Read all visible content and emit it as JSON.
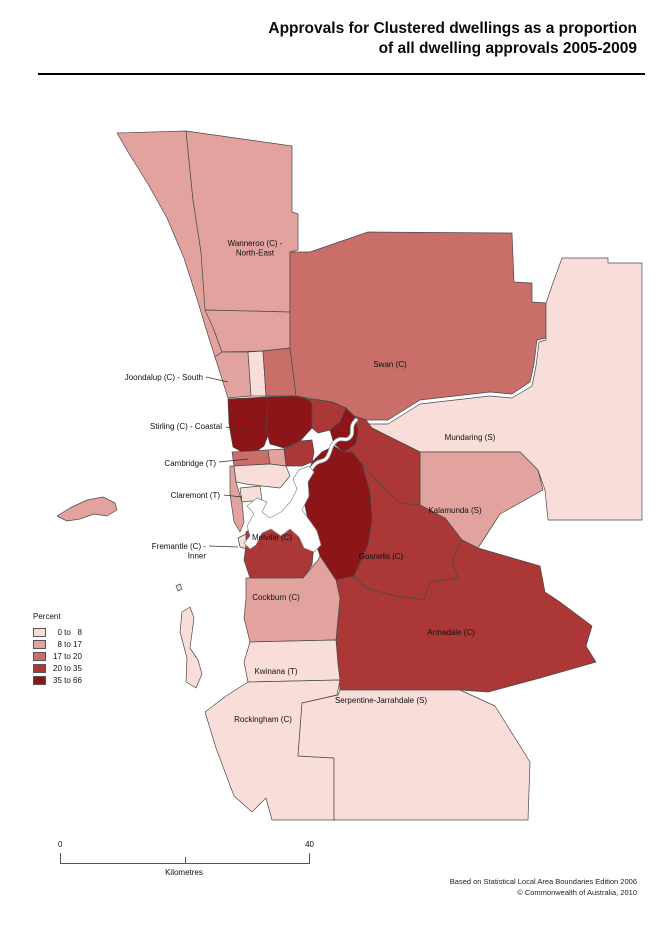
{
  "title": {
    "line1": "Approvals for Clustered dwellings as a proportion",
    "line2": "of all dwelling approvals 2005-2009"
  },
  "legend": {
    "title": "Percent",
    "items": [
      {
        "label": "  0 to   8",
        "color": "#f8ddd8"
      },
      {
        "label": "  8 to 17",
        "color": "#e2a29d"
      },
      {
        "label": "17 to 20",
        "color": "#c96e68"
      },
      {
        "label": "20 to 35",
        "color": "#ab3736"
      },
      {
        "label": "35 to 66",
        "color": "#8d1517"
      }
    ]
  },
  "scalebar": {
    "start": "0",
    "end": "40",
    "units": "Kilometres"
  },
  "footer": {
    "line1": "Based on Statistical Local Area Boundaries Edition 2006",
    "line2": "© Commonwealth of Australia, 2010"
  },
  "map": {
    "border_color": "#4a4a4a",
    "water_color": "#ffffff",
    "regions": [
      {
        "id": "wanneroo-coastal",
        "class": 1,
        "points": "117,133 186,131 193,200 201,252 207,300 214,330 222,352 215,357 207,332 198,302 184,258 167,218 148,184 128,152"
      },
      {
        "id": "wanneroo-north-east",
        "class": 1,
        "points": "186,131 292,146 292,212 298,214 298,250 290,252 290,312 205,310 201,252 193,200"
      },
      {
        "id": "wanneroo-south",
        "class": 1,
        "points": "205,310 290,312 290,348 262,351 222,352 214,330"
      },
      {
        "id": "joondalup-south",
        "class": 1,
        "points": "215,357 222,352 248,352 251,396 228,398"
      },
      {
        "id": "joondalup-east",
        "class": 0,
        "points": "248,352 263,351 266,396 251,396"
      },
      {
        "id": "wanneroo-sliver",
        "class": 2,
        "points": "263,351 290,348 296,396 266,396"
      },
      {
        "id": "swan",
        "class": 2,
        "points": "290,252 310,252 368,232 512,233 514,282 532,283 532,302 546,303 546,338 537,340 534,364 530,382 512,394 490,392 420,400 388,420 366,420 354,416 346,408 332,402 296,396 290,348 290,312"
      },
      {
        "id": "mundaring",
        "class": 0,
        "points": "562,258 608,258 608,263 642,263 642,520 548,520 545,490 538,470 520,452 420,452 372,428 366,424 388,424 420,404 490,396 512,398 532,386 536,366 539,342 546,340 546,303 554,280"
      },
      {
        "id": "kalamunda",
        "class": 1,
        "points": "420,452 520,452 538,470 543,490 500,514 478,548 462,540 445,518 420,505"
      },
      {
        "id": "stirling-coastal",
        "class": 4,
        "points": "228,399 266,397 268,404 270,430 264,446 254,453 242,452 233,447 229,424"
      },
      {
        "id": "stirling-central",
        "class": 4,
        "points": "266,397 296,396 308,399 312,404 312,428 300,441 284,448 270,444 266,428 268,404"
      },
      {
        "id": "stirling-east",
        "class": 3,
        "points": "308,399 332,402 346,408 340,422 330,430 318,433 312,428 312,404"
      },
      {
        "id": "bayswater",
        "class": 4,
        "points": "330,430 340,422 346,408 354,416 358,430 356,444 344,452 334,444"
      },
      {
        "id": "belmont",
        "class": 3,
        "points": "354,416 366,420 372,428 420,452 420,505 400,503 378,482 362,464 352,452 344,452 356,444 358,430"
      },
      {
        "id": "perth-vincent",
        "class": 3,
        "points": "284,449 300,441 312,440 314,452 312,462 302,466 286,466"
      },
      {
        "id": "cambridge",
        "class": 2,
        "points": "232,452 268,450 270,464 234,466"
      },
      {
        "id": "subiaco",
        "class": 1,
        "points": "268,450 284,449 286,466 270,464"
      },
      {
        "id": "nedlands",
        "class": 0,
        "points": "234,466 270,464 286,466 290,476 280,488 262,486 246,484 236,482"
      },
      {
        "id": "claremont",
        "class": 0,
        "points": "240,488 260,486 262,500 242,502"
      },
      {
        "id": "cottesloe",
        "class": 1,
        "points": "230,466 234,466 236,482 242,502 244,522 240,532 234,522 230,494"
      },
      {
        "id": "east-fremantle",
        "class": 3,
        "points": "253,524 263,521 266,532 256,534"
      },
      {
        "id": "fremantle-inner",
        "class": 0,
        "points": "238,538 248,533 253,541 247,549 240,547"
      },
      {
        "id": "melville",
        "class": 3,
        "points": "246,532 258,524 272,520 288,512 300,518 308,528 314,545 312,565 303,578 250,578 244,560 246,545"
      },
      {
        "id": "canning",
        "class": 4,
        "points": "312,462 322,452 334,446 344,452 352,452 362,464 370,492 372,520 368,545 354,576 336,580 320,556 308,520 302,492"
      },
      {
        "id": "gosnells",
        "class": 3,
        "points": "362,464 378,482 400,503 420,505 445,518 462,540 452,562 458,578 430,582 424,600 396,596 366,588 354,576 368,545 372,520 370,492"
      },
      {
        "id": "armadale",
        "class": 3,
        "points": "354,576 366,588 396,596 424,600 430,582 458,578 452,562 462,540 478,548 540,566 545,592 560,602 592,626 586,646 596,662 540,678 488,692 460,690 340,690 338,664 336,640 340,598 336,580"
      },
      {
        "id": "cockburn",
        "class": 1,
        "points": "246,578 303,578 318,560 320,556 336,580 340,598 336,640 250,642 244,618 246,598"
      },
      {
        "id": "kwinana",
        "class": 0,
        "points": "250,642 336,640 338,664 340,680 248,682 244,662"
      },
      {
        "id": "rockingham",
        "class": 0,
        "points": "248,682 340,680 337,695 302,703 298,756 334,758 334,820 272,820 266,798 252,812 234,796 216,748 205,712 226,696"
      },
      {
        "id": "serpentine-jarrahdale",
        "class": 0,
        "points": "340,690 460,690 495,706 530,762 528,820 334,820 334,758 298,756 302,703 338,695"
      },
      {
        "id": "garden-island",
        "class": 0,
        "points": "182,612 190,607 194,618 190,648 198,660 202,674 196,688 186,682 187,658 180,632"
      },
      {
        "id": "rottnest-island",
        "class": 1,
        "points": "57,516 70,508 87,500 103,497 115,503 117,510 107,516 94,514 80,519 67,521"
      },
      {
        "id": "small-island",
        "class": 0,
        "points": "176,586 180,584 182,589 178,591"
      }
    ],
    "river": {
      "estuary_points": "244,543 250,536 247,526 254,514 247,506 257,498 267,502 262,512 270,518 281,512 291,501 297,489 293,479 299,470 309,466 314,472 308,482 309,496 302,510 310,521 317,531 321,545 314,552 304,548 299,537 290,529 281,536 271,529 262,533 256,545 250,549",
      "channel_path": "M312,468 C318,458 324,464 328,456 C332,448 330,446 336,441 C342,436 346,443 351,436 C354,431 349,427 356,420"
    },
    "labels": [
      {
        "id": "wanneroo",
        "lines": [
          "Wanneroo (C) -",
          "North-East"
        ],
        "x": 255,
        "y": 246,
        "anchor": "middle"
      },
      {
        "id": "swan",
        "lines": [
          "Swan (C)"
        ],
        "x": 390,
        "y": 367,
        "anchor": "middle"
      },
      {
        "id": "joondalup",
        "lines": [
          "Joondalup (C) - South"
        ],
        "x": 203,
        "y": 380,
        "anchor": "end",
        "leader": [
          206,
          377,
          228,
          382
        ]
      },
      {
        "id": "mundaring",
        "lines": [
          "Mundaring (S)"
        ],
        "x": 470,
        "y": 440,
        "anchor": "middle"
      },
      {
        "id": "stirling",
        "lines": [
          "Stirling (C) - Coastal"
        ],
        "x": 222,
        "y": 429,
        "anchor": "end",
        "leader": [
          226,
          427,
          248,
          431
        ]
      },
      {
        "id": "cambridge",
        "lines": [
          "Cambridge (T)"
        ],
        "x": 216,
        "y": 466,
        "anchor": "end",
        "leader": [
          219,
          462,
          248,
          459
        ]
      },
      {
        "id": "claremont",
        "lines": [
          "Claremont (T)"
        ],
        "x": 220,
        "y": 498,
        "anchor": "end",
        "leader": [
          224,
          495,
          242,
          497
        ]
      },
      {
        "id": "kalamunda",
        "lines": [
          "Kalamunda (S)"
        ],
        "x": 455,
        "y": 513,
        "anchor": "middle"
      },
      {
        "id": "melville",
        "lines": [
          "Melville (C)"
        ],
        "x": 272,
        "y": 540,
        "anchor": "middle"
      },
      {
        "id": "fremantle",
        "lines": [
          "Fremantle (C) -",
          "Inner"
        ],
        "x": 206,
        "y": 549,
        "anchor": "end",
        "leader": [
          209,
          546,
          238,
          547
        ]
      },
      {
        "id": "gosnells",
        "lines": [
          "Gosnells (C)"
        ],
        "x": 381,
        "y": 559,
        "anchor": "middle"
      },
      {
        "id": "cockburn",
        "lines": [
          "Cockburn (C)"
        ],
        "x": 276,
        "y": 600,
        "anchor": "middle"
      },
      {
        "id": "armadale",
        "lines": [
          "Armadale (C)"
        ],
        "x": 451,
        "y": 635,
        "anchor": "middle"
      },
      {
        "id": "kwinana",
        "lines": [
          "Kwinana (T)"
        ],
        "x": 276,
        "y": 674,
        "anchor": "middle"
      },
      {
        "id": "serpentine",
        "lines": [
          "Serpentine-Jarrahdale (S)"
        ],
        "x": 381,
        "y": 703,
        "anchor": "middle"
      },
      {
        "id": "rockingham",
        "lines": [
          "Rockingham (C)"
        ],
        "x": 263,
        "y": 722,
        "anchor": "middle"
      }
    ]
  }
}
